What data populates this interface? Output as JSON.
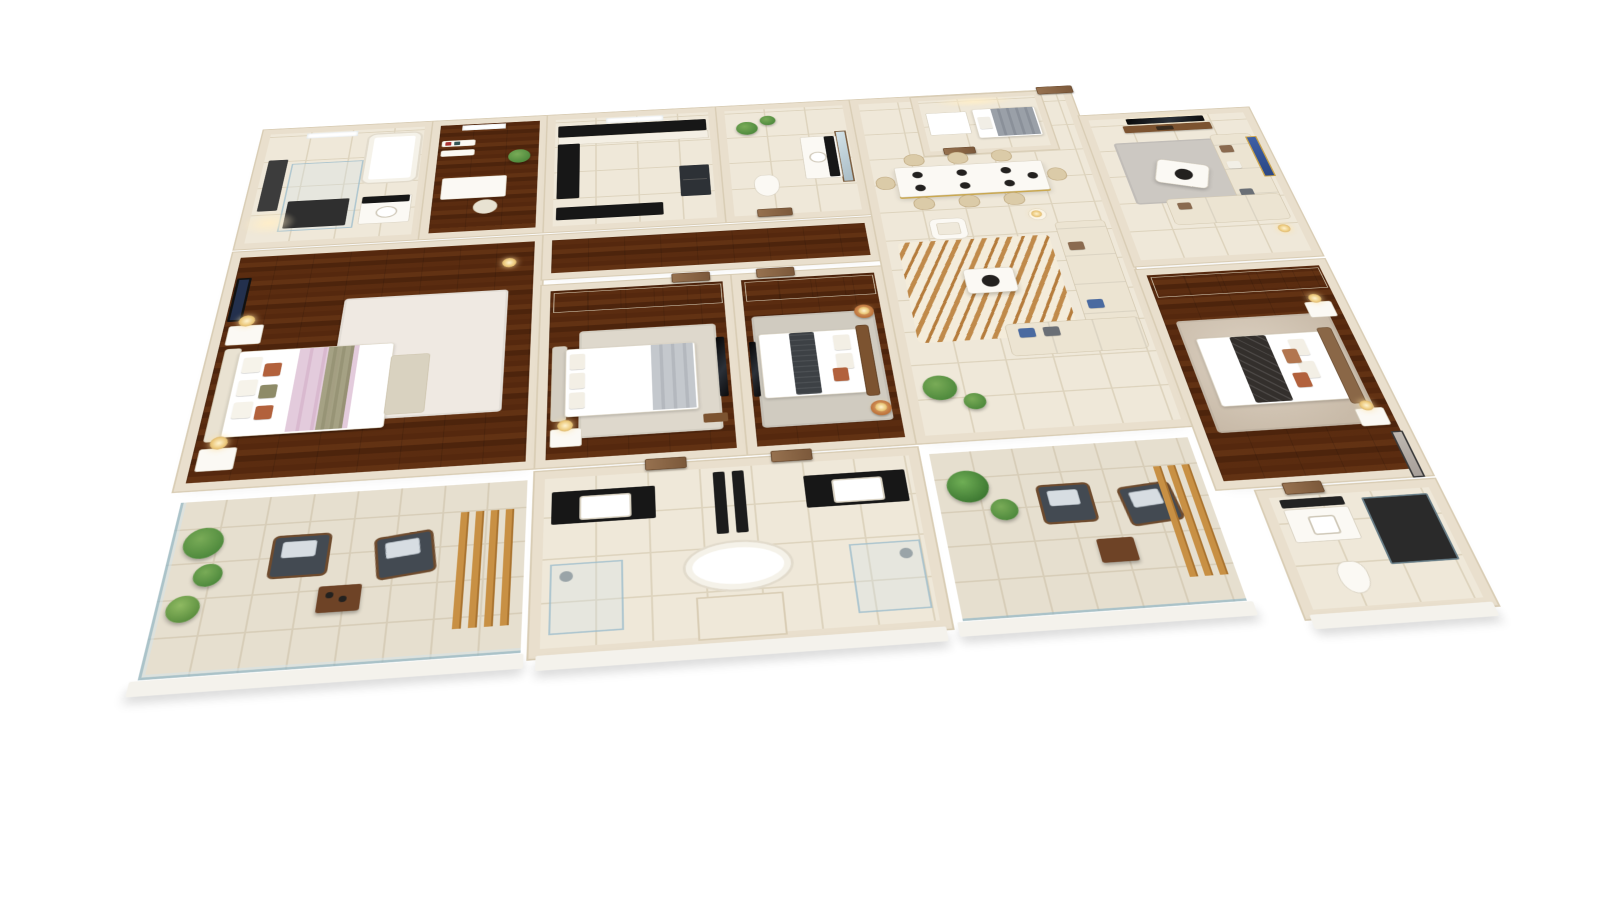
{
  "scene": {
    "kind": "3d-isometric-floor-plan-render",
    "counts": {
      "bedrooms": 4,
      "bathrooms": 4,
      "balconies": 2,
      "dining_seats": 8
    },
    "rooms": [
      {
        "id": "master-bathroom",
        "furniture": [
          "glass-shower",
          "bathtub",
          "vanity-sink",
          "dark-feature-panel",
          "skylight"
        ]
      },
      {
        "id": "dressing-area",
        "furniture": [
          "desk",
          "desk-chair",
          "wall-shelves",
          "potted-plant",
          "skylight"
        ]
      },
      {
        "id": "master-bedroom",
        "furniture": [
          "double-bed",
          "pink-throw",
          "area-rug",
          "nightstand-x2",
          "table-lamp-x2",
          "wall-art"
        ]
      },
      {
        "id": "kitchen",
        "furniture": [
          "l-shaped-counter",
          "window",
          "refrigerator",
          "peninsula-counter"
        ]
      },
      {
        "id": "bedroom-2",
        "furniture": [
          "wardrobe",
          "double-bed",
          "area-rug",
          "tv-panel",
          "nightstand",
          "table-lamp"
        ]
      },
      {
        "id": "powder-room",
        "furniture": [
          "vanity-sink",
          "mirror",
          "toilet",
          "potted-plant-x2"
        ]
      },
      {
        "id": "bedroom-3",
        "furniture": [
          "wardrobe",
          "double-bed",
          "charcoal-runner",
          "area-rug",
          "round-side-table-x2",
          "table-lamp-x2",
          "tv-panel"
        ]
      },
      {
        "id": "shared-bathroom",
        "furniture": [
          "vanity-x2",
          "freestanding-oval-tub",
          "divider-panel-x2",
          "glass-shower-x2"
        ]
      },
      {
        "id": "utility-room",
        "furniture": [
          "single-bed",
          "shower-tray"
        ]
      },
      {
        "id": "entrance-hall",
        "furniture": [
          "main-door"
        ]
      },
      {
        "id": "dining-area",
        "furniture": [
          "dining-table",
          "dining-chair-x8",
          "place-settings"
        ]
      },
      {
        "id": "family-lounge",
        "furniture": [
          "zebra-rug",
          "sectional-sofa",
          "chaise",
          "armchair",
          "coffee-table",
          "side-table",
          "floor-plant-x2"
        ]
      },
      {
        "id": "living-room",
        "furniture": [
          "wall-tv",
          "media-console",
          "l-sectional-sofa",
          "triangular-coffee-table",
          "area-rug",
          "blue-gold-art"
        ]
      },
      {
        "id": "bedroom-4",
        "furniture": [
          "sliding-wardrobe",
          "double-bed",
          "quilted-runner",
          "area-rug",
          "nightstand-x2",
          "table-lamp-x2",
          "gray-art"
        ]
      },
      {
        "id": "ensuite-bathroom",
        "furniture": [
          "vanity-sink",
          "dark-shower",
          "toilet"
        ]
      },
      {
        "id": "balcony-1",
        "furniture": [
          "wicker-chair-x2",
          "timber-side-table",
          "potted-plant-x3",
          "timber-slat-screen",
          "glass-railing"
        ]
      },
      {
        "id": "balcony-2",
        "furniture": [
          "wicker-chair-x2",
          "timber-side-table",
          "potted-plant-x2",
          "timber-slat-screen",
          "glass-railing"
        ]
      }
    ]
  },
  "palette": {
    "background": "#ffffff",
    "wall": "#e9dfcd",
    "wall_edge": "#d9cdb5",
    "floor_tile": "#efe8d9",
    "tile_grout": "#ddd3bd",
    "wood": "#9a6c42",
    "terrace": "#e6dfcf",
    "dark": "#23211f",
    "black_counter": "#171717",
    "white_furn": "#fbf9f4",
    "cream_sofa": "#ece4d2",
    "rust": "#b2613c",
    "olive": "#8e8b68",
    "blush": "#e3cbdc",
    "gold": "#c89044",
    "green": "#4f8a3d",
    "green_light": "#79ab57",
    "door_wood": "#8a6747",
    "blue_art": "#3e5fa5",
    "charcoal": "#3d4145"
  }
}
